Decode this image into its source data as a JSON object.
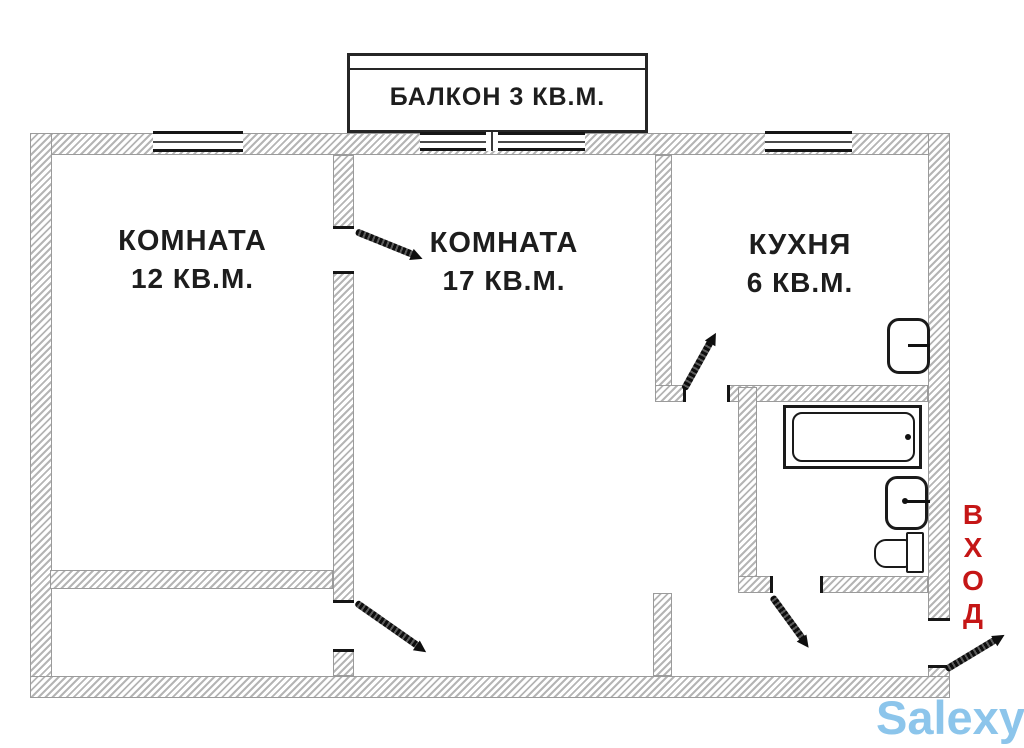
{
  "plan": {
    "balcony_label": "БАЛКОН 3 КВ.М.",
    "room_small": {
      "name": "КОМНАТА",
      "area": "12 КВ.М."
    },
    "room_large": {
      "name": "КОМНАТА",
      "area": "17 КВ.М."
    },
    "kitchen": {
      "name": "КУХНЯ",
      "area": "6 КВ.М."
    },
    "entrance_label": "ВХОД",
    "entrance_letters": [
      "В",
      "Х",
      "О",
      "Д"
    ],
    "fixtures": [
      "bathtub",
      "kitchen-sink",
      "bathroom-sink",
      "toilet"
    ]
  },
  "watermark": {
    "text": "Salexy"
  },
  "colors": {
    "entrance_red": "#c51616",
    "watermark_blue": "#8cc5eb",
    "wall_hatch_gray": "#b5b5b5",
    "line_dark": "#161616"
  }
}
